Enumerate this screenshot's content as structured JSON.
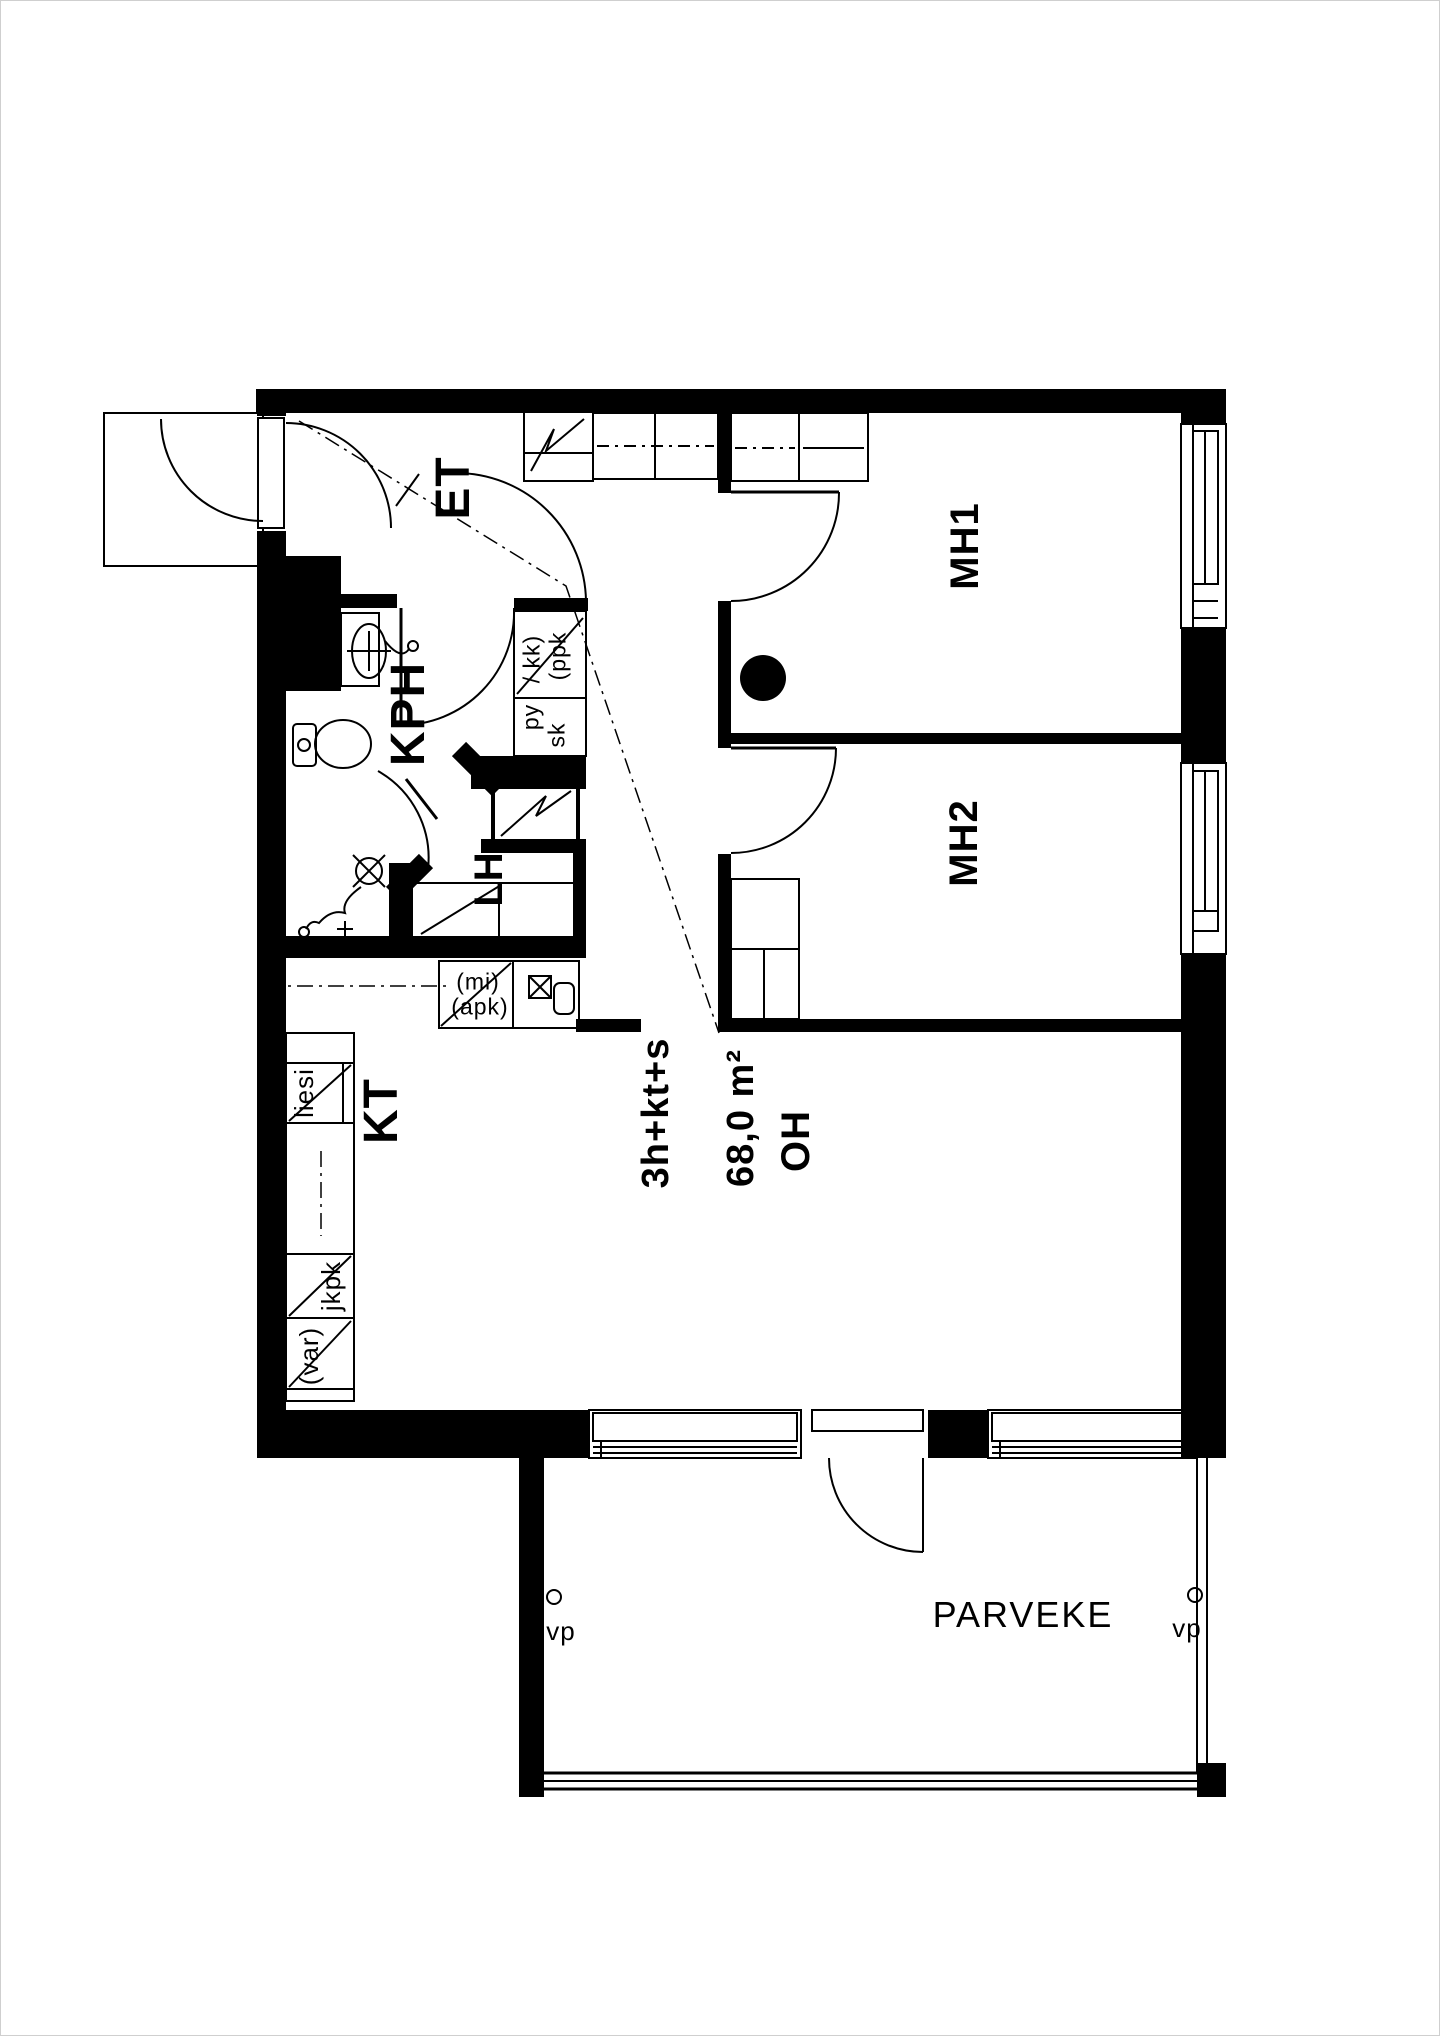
{
  "document": {
    "type": "apartment floor plan",
    "apartment": {
      "layout_type": "3h+kt+s",
      "area": "68,0 m²"
    },
    "line_color": "#000000",
    "background_color": "#ffffff"
  },
  "labels": {
    "et": "ET",
    "kph": "KPH",
    "lh": "LH",
    "kt": "KT",
    "mh1": "MH1",
    "mh2": "MH2",
    "oh": "OH",
    "layout_type": "3h+kt+s",
    "area": "68,0 m²",
    "parveke": "PARVEKE",
    "vp": "vp",
    "liesi": "liesi",
    "jkpk": "jkpk",
    "var": "(var)",
    "mi": "(mi)",
    "apk": "(apk)",
    "ppk_line1": "(ppk",
    "ppk_line2": "/ kk)",
    "py": "py",
    "sk": "sk"
  },
  "rooms": [
    {
      "id": "et",
      "label": "ET",
      "meaning": "hallway"
    },
    {
      "id": "kph",
      "label": "KPH",
      "meaning": "bathroom"
    },
    {
      "id": "lh",
      "label": "LH",
      "meaning": "sauna"
    },
    {
      "id": "kt",
      "label": "KT",
      "meaning": "kitchen"
    },
    {
      "id": "mh1",
      "label": "MH1",
      "meaning": "bedroom 1"
    },
    {
      "id": "mh2",
      "label": "MH2",
      "meaning": "bedroom 2"
    },
    {
      "id": "oh",
      "label": "OH",
      "meaning": "living room"
    },
    {
      "id": "parveke",
      "label": "PARVEKE",
      "meaning": "balcony"
    }
  ],
  "fixture_labels": [
    {
      "id": "liesi",
      "label": "liesi"
    },
    {
      "id": "jkpk",
      "label": "jkpk"
    },
    {
      "id": "var",
      "label": "(var)"
    },
    {
      "id": "mi",
      "label": "(mi)"
    },
    {
      "id": "apk",
      "label": "(apk)"
    },
    {
      "id": "ppk_kk",
      "label": "(ppk / kk)"
    },
    {
      "id": "py",
      "label": "py"
    },
    {
      "id": "sk",
      "label": "sk"
    },
    {
      "id": "vp_left",
      "label": "vp"
    },
    {
      "id": "vp_right",
      "label": "vp"
    }
  ]
}
